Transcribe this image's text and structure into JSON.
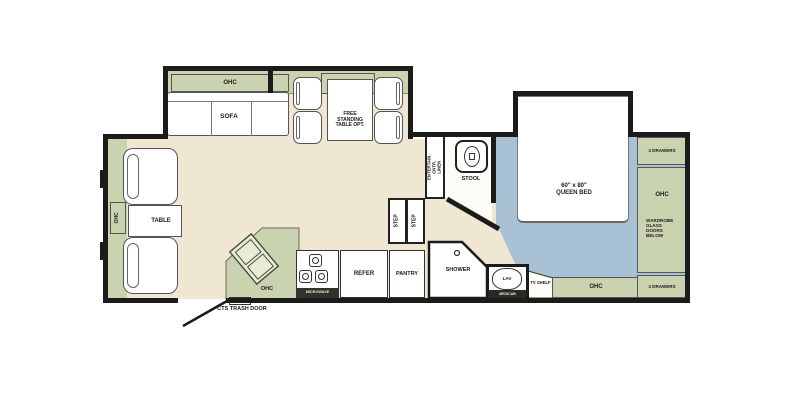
{
  "colors": {
    "floor_cream": "#efe7d2",
    "cabinet_green": "#c9d3b0",
    "bedroom_blue": "#a8c1d5",
    "wall_black": "#1b1b1b"
  },
  "living": {
    "sofa_ohc_label": "OHC",
    "sofa_label": "SOFA",
    "dinette_ohc_label": "OHC",
    "dinette_table_label": "FREE STANDING TABLE OPT.",
    "front_ohc_label": "OHC",
    "front_table_label": "TABLE"
  },
  "kitchen": {
    "counter_ohc_label": "OHC",
    "microwave_label": "MICROWAVE",
    "refer_label": "REFER",
    "pantry_label": "PANTRY",
    "entry_door_label": "CTS TRASH DOOR"
  },
  "hall": {
    "step_label_1": "STEP",
    "step_label_2": "STEP",
    "entertainment_label": "ENTERTAIN. CNTR. LINEN"
  },
  "bath": {
    "stool_label": "STOOL",
    "shower_label": "SHOWER",
    "lav_label": "LAV",
    "medicab_label": "MEDICAB"
  },
  "bedroom": {
    "bed_label": "60\" x 80\" QUEEN BED",
    "drawers_top_label": "3 DRAWERS",
    "wardrobe_ohc_label": "OHC",
    "wardrobe_label": "WARDROBE GLASS DOORS BELOW",
    "drawers_bottom_label": "3 DRAWERS",
    "tv_shelf_label": "TV SHELF",
    "bed_ohc_label": "OHC"
  }
}
